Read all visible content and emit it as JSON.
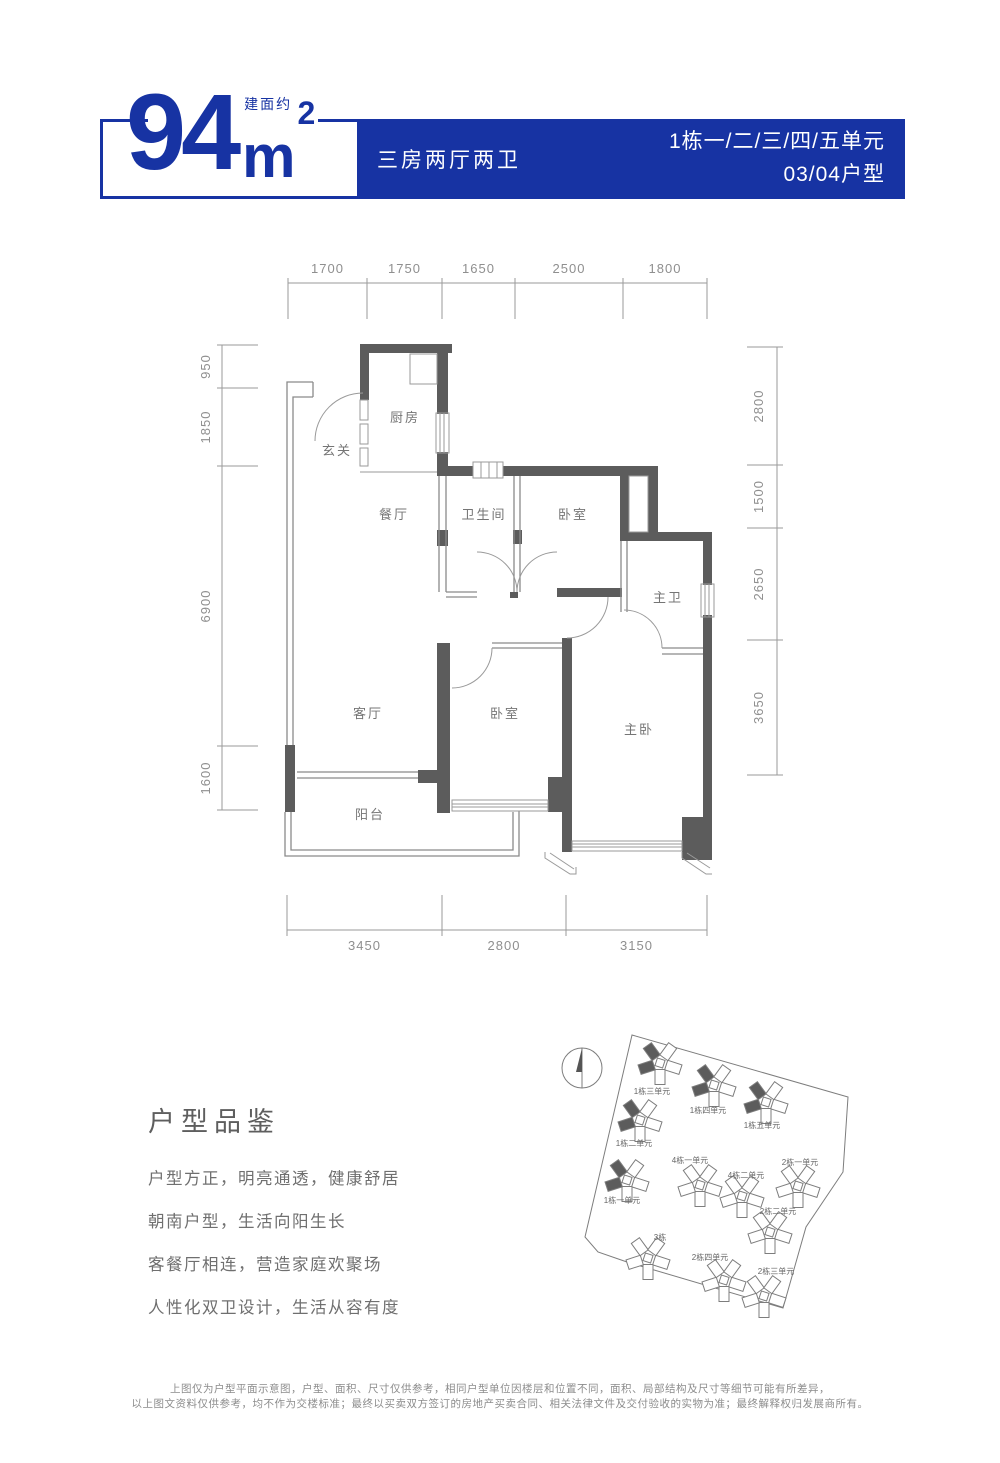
{
  "colors": {
    "accent": "#1733A3",
    "wall": "#5c5c5c"
  },
  "header": {
    "area_prefix": "建面约",
    "area_value": "94",
    "area_unit": "m",
    "area_exponent": "2",
    "layout_type": "三房两厅两卫",
    "unit_line1": "1栋一/二/三/四/五单元",
    "unit_line2": "03/04户型"
  },
  "floor_plan": {
    "rooms": [
      "厨房",
      "玄关",
      "餐厅",
      "卫生间",
      "卧室",
      "主卫",
      "客厅",
      "卧室",
      "主卧",
      "阳台"
    ],
    "dims": {
      "top": [
        "1700",
        "1750",
        "1650",
        "2500",
        "1800"
      ],
      "left": [
        "950",
        "1850",
        "6900",
        "1600"
      ],
      "right": [
        "2800",
        "1500",
        "2650",
        "3650"
      ],
      "bottom": [
        "3450",
        "2800",
        "3150"
      ]
    }
  },
  "highlights": {
    "title": "户型品鉴",
    "items": [
      "户型方正，明亮通透，健康舒居",
      "朝南户型，生活向阳生长",
      "客餐厅相连，营造家庭欢聚场",
      "人性化双卫设计，生活从容有度"
    ]
  },
  "site_plan": {
    "north_label": "N",
    "caption": "总平面位置示意图",
    "buildings": [
      {
        "label": "1栋三单元",
        "highlighted": true
      },
      {
        "label": "1栋四单元",
        "highlighted": true
      },
      {
        "label": "1栋五单元",
        "highlighted": true
      },
      {
        "label": "1栋二单元",
        "highlighted": true
      },
      {
        "label": "1栋一单元",
        "highlighted": true
      },
      {
        "label": "4栋一单元",
        "highlighted": false
      },
      {
        "label": "4栋二单元",
        "highlighted": false
      },
      {
        "label": "2栋一单元",
        "highlighted": false
      },
      {
        "label": "2栋二单元",
        "highlighted": false
      },
      {
        "label": "3栋",
        "highlighted": false
      },
      {
        "label": "2栋四单元",
        "highlighted": false
      },
      {
        "label": "2栋三单元",
        "highlighted": false
      }
    ]
  },
  "disclaimer": {
    "line1": "上图仅为户型平面示意图，户型、面积、尺寸仅供参考，相同户型单位因楼层和位置不同，面积、局部结构及尺寸等细节可能有所差异，",
    "line2": "以上图文资料仅供参考，均不作为交楼标准；最终以买卖双方签订的房地产买卖合同、相关法律文件及交付验收的实物为准；最终解释权归发展商所有。"
  }
}
